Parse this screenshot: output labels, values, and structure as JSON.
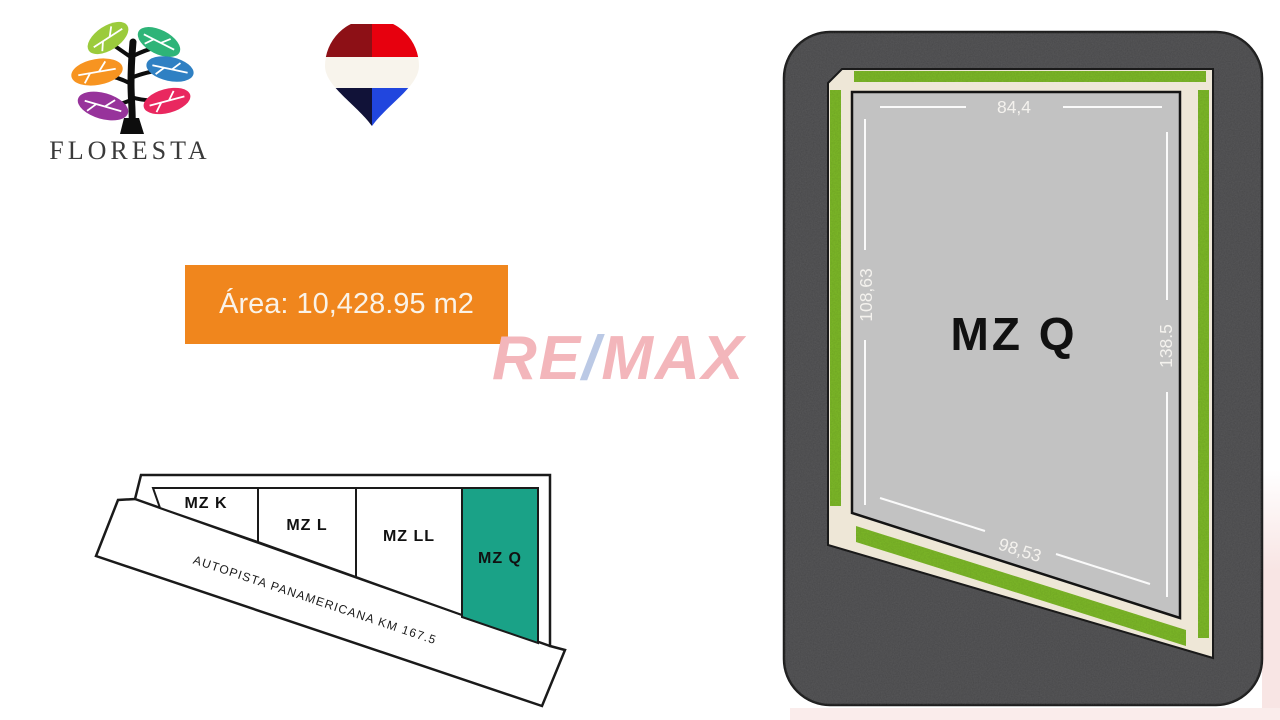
{
  "logo": {
    "wordmark": "FLORESTA",
    "wordmark_color": "#3a3a3a",
    "trunk_color": "#0d0d0d",
    "leaf_colors": [
      "#9bcb3c",
      "#2eb478",
      "#f79421",
      "#2f80c3",
      "#97339b",
      "#e9285f"
    ]
  },
  "location_pin": {
    "colors": {
      "red_dark": "#8d1016",
      "red": "#e7000e",
      "white": "#f8f4ec",
      "navy": "#111238",
      "blue": "#2146de"
    }
  },
  "area_box": {
    "text": "Área: 10,428.95 m2",
    "background": "#f0861d",
    "text_color": "#faf3e8"
  },
  "watermark": {
    "re": "RE",
    "slash": "/",
    "max": "MAX",
    "letter_color": "#f3b6bb",
    "slash_color": "#bbc9e5"
  },
  "site_plan": {
    "lot_label": "MZ Q",
    "measurements": {
      "top": "84,4",
      "left": "108,63",
      "right": "138.5",
      "bottom": "98,53"
    },
    "colors": {
      "asphalt": "#4c4c4e",
      "grass": "#7db928",
      "sidewalk": "#eee7d7",
      "plot": "#c2c2c2"
    }
  },
  "mini_map": {
    "lots": [
      {
        "label": "MZ K",
        "highlighted": false
      },
      {
        "label": "MZ L",
        "highlighted": false
      },
      {
        "label": "MZ LL",
        "highlighted": false
      },
      {
        "label": "MZ Q",
        "highlighted": true
      }
    ],
    "highlight_color": "#1aa287",
    "highlight_label_color": "#ffffff",
    "road_label": "AUTOPISTA PANAMERICANA KM 167.5"
  }
}
